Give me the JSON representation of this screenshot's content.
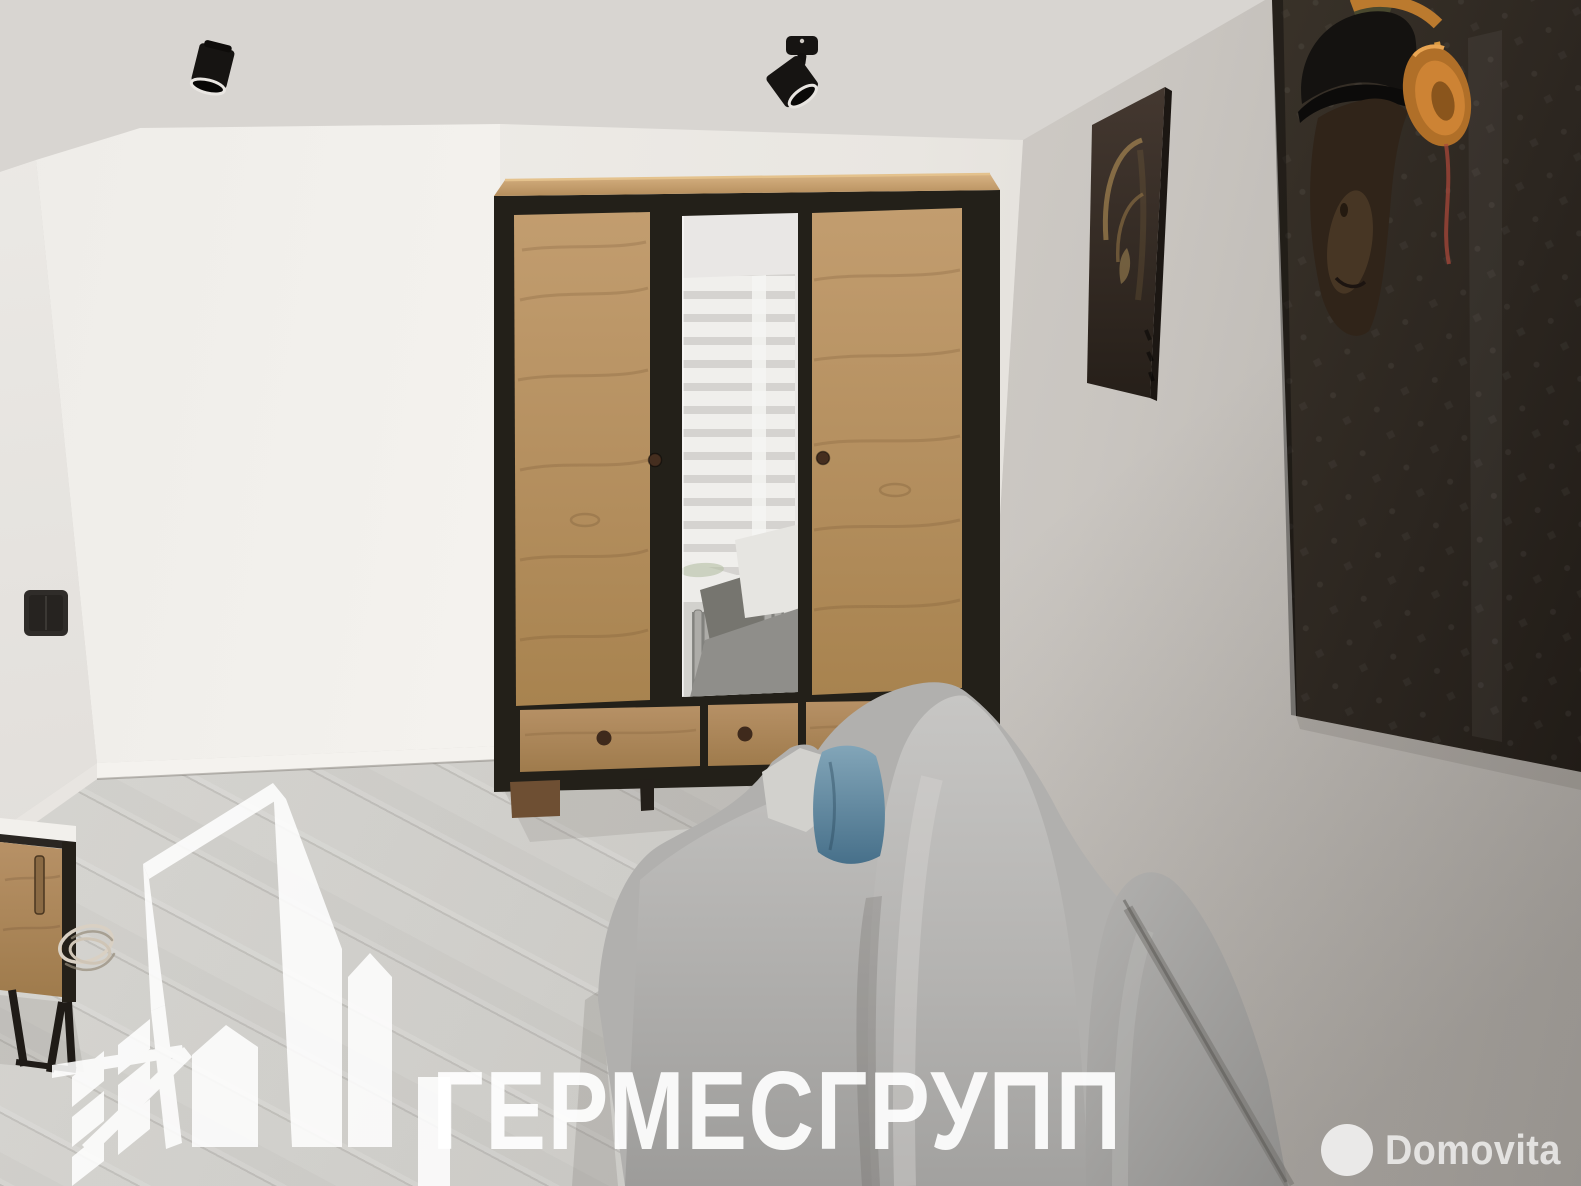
{
  "meta": {
    "kind": "real-estate interior photograph",
    "room": "living room with wardrobe, grey sofa and monkey wall art"
  },
  "watermarks": {
    "agency": {
      "text": "ГЕРМЕСГРУПП",
      "logo": "city-buildings-outline-icon",
      "color": "#ffffff"
    },
    "portal": {
      "name": "Domovita",
      "logo": "white-circle-icon",
      "color": "#ffffff"
    }
  },
  "scene_objects": [
    "ceiling-spotlight-left",
    "ceiling-spotlight-right",
    "light-switch",
    "three-door-wardrobe-wood-black",
    "wardrobe-mirror-reflection-window-blinds-radiator-sofa",
    "small-brown-abstract-monkey-poster",
    "large-monkey-with-orange-headphones-poster",
    "grey-fabric-sofa",
    "blue-accent-pillow",
    "wooden-tv-stand-black-frame",
    "white-cable-coil",
    "grey-laminate-floor",
    "white-baseboard"
  ],
  "palette": {
    "ceiling": "#dedad6",
    "wall_light": "#f1efeb",
    "wall_right": "#c9c5c0",
    "floor": "#cdccc8",
    "wood": "#bb9463",
    "frame_black": "#232019",
    "sofa_grey": "#b1b0ae",
    "pillow_blue": "#5d87a0",
    "headphones_orange": "#cd8334",
    "poster_dark": "#2a2219",
    "watermark": "#ffffff"
  }
}
